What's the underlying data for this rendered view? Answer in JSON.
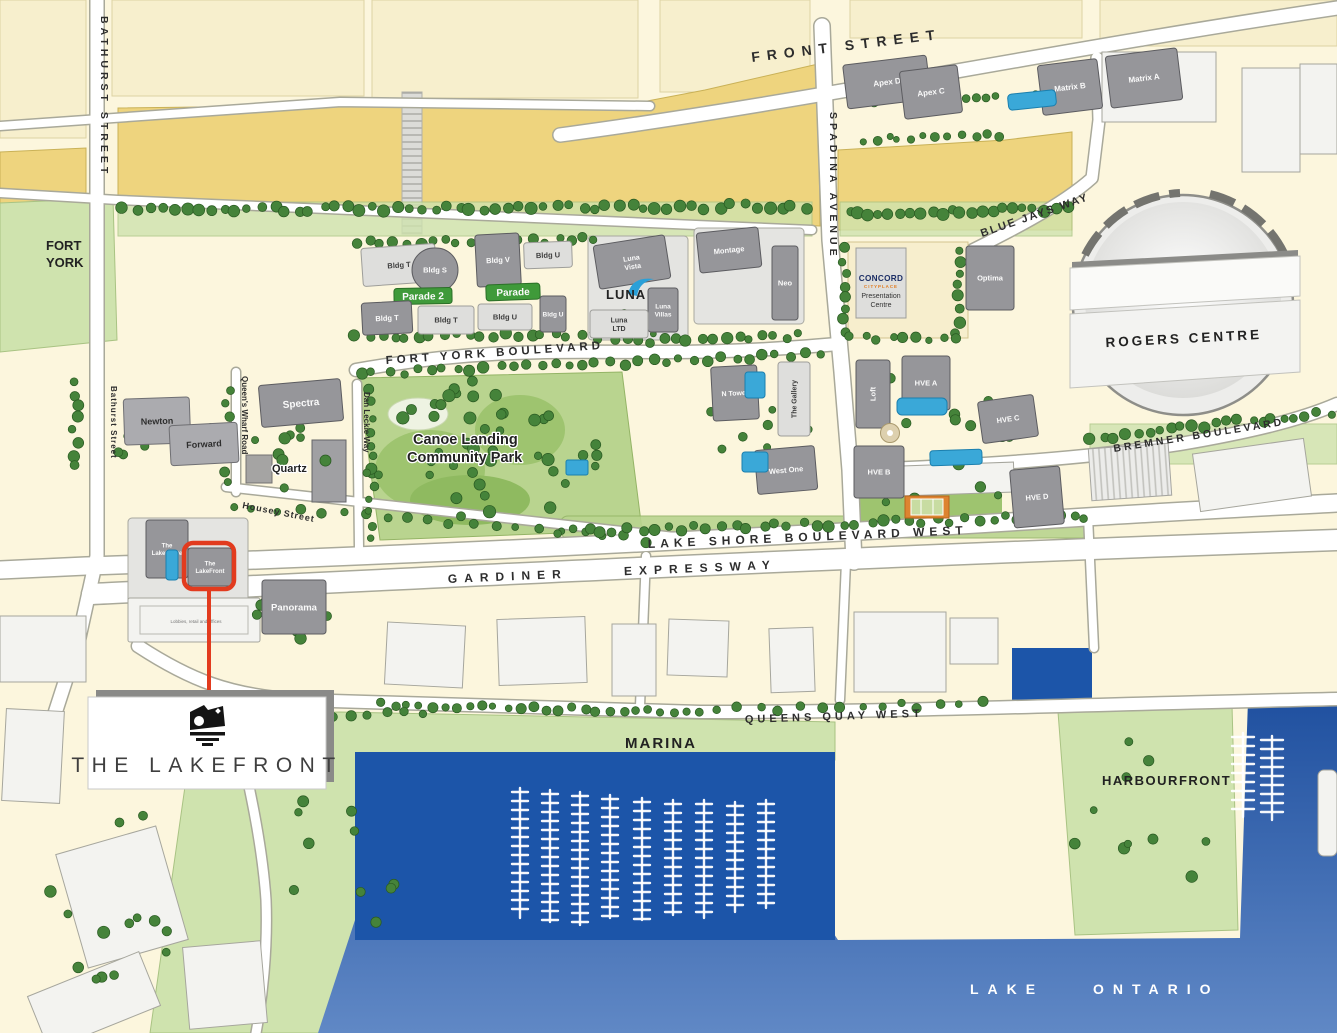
{
  "map": {
    "brand": {
      "name": "THE LAKEFRONT"
    },
    "streets": {
      "front": "FRONT STREET",
      "bathurst_n": "BATHURST STREET",
      "bathurst_s": "Bathurst Street",
      "spadina": "SPADINA AVENUE",
      "blue_jays": "BLUE JAYS WAY",
      "fort_york_blvd": "FORT YORK BOULEVARD",
      "queens_wharf": "Queen's Wharf Road",
      "dan_leckie": "Dan Leckie Way",
      "housey": "Housey Street",
      "lake_shore": "LAKE SHORE BOULEVARD WEST",
      "gardiner": "GARDINER EXPRESSWAY",
      "bremner": "BREMNER BOULEVARD",
      "queens_quay": "QUEENS QUAY WEST"
    },
    "areas": {
      "fort_line1": "FORT",
      "fort_line2": "YORK",
      "canoe_line1": "Canoe Landing",
      "canoe_line2": "Community Park",
      "quartz": "Quartz",
      "marina": "MARINA",
      "harbourfront": "HARBOURFRONT",
      "rogers": "ROGERS CENTRE",
      "lake_ontario": "LAKE ONTARIO",
      "lobbies_note": "Lobbies, retail and offices"
    },
    "concord": {
      "brand": "CONCORD",
      "sub": "CITYPLACE",
      "line1": "Presentation",
      "line2": "Centre"
    },
    "luna_logo": "LUNA",
    "colors": {
      "callout_red": "#e23b1e",
      "court_orange": "#dd8430",
      "water_deep": "#1c55a9",
      "rail_yellow": "#eed47e",
      "park_green": "#b9d48f"
    },
    "buildings": [
      {
        "id": "apex-d",
        "label": "Apex D",
        "x": 845,
        "y": 60,
        "w": 84,
        "h": 44,
        "rot": -7,
        "kind": "dark",
        "fs": 8
      },
      {
        "id": "apex-c",
        "label": "Apex C",
        "x": 902,
        "y": 68,
        "w": 58,
        "h": 48,
        "rot": -7,
        "kind": "dark",
        "fs": 8
      },
      {
        "id": "matrix-b",
        "label": "Matrix B",
        "x": 1040,
        "y": 62,
        "w": 60,
        "h": 50,
        "rot": -7,
        "kind": "dark",
        "fs": 8
      },
      {
        "id": "matrix-a",
        "label": "Matrix A",
        "x": 1108,
        "y": 52,
        "w": 72,
        "h": 52,
        "rot": -7,
        "kind": "dark",
        "fs": 8
      },
      {
        "id": "bldg-t-1",
        "label": "Bldg T",
        "x": 362,
        "y": 246,
        "w": 74,
        "h": 38,
        "rot": -4,
        "kind": "light",
        "fs": 7.5
      },
      {
        "id": "bldg-s",
        "label": "Bldg S",
        "x": 412,
        "y": 248,
        "w": 46,
        "h": 44,
        "rot": 0,
        "kind": "dark",
        "fs": 7.5,
        "rx": 22
      },
      {
        "id": "parade-2-sign",
        "label": "Parade 2",
        "x": 394,
        "y": 288,
        "w": 58,
        "h": 16,
        "rot": -1,
        "kind": "sign",
        "fs": 10
      },
      {
        "id": "bldg-t-2",
        "label": "Bldg T",
        "x": 362,
        "y": 302,
        "w": 50,
        "h": 32,
        "rot": -3,
        "kind": "dark",
        "fs": 7.5
      },
      {
        "id": "bldg-t-3",
        "label": "Bldg T",
        "x": 418,
        "y": 306,
        "w": 56,
        "h": 28,
        "rot": 0,
        "kind": "light",
        "fs": 7.5
      },
      {
        "id": "bldg-v",
        "label": "Bldg V",
        "x": 476,
        "y": 234,
        "w": 44,
        "h": 52,
        "rot": -3,
        "kind": "dark",
        "fs": 7.5
      },
      {
        "id": "bldg-u-1",
        "label": "Bldg U",
        "x": 524,
        "y": 242,
        "w": 48,
        "h": 26,
        "rot": -2,
        "kind": "light",
        "fs": 7.5
      },
      {
        "id": "parade-sign",
        "label": "Parade",
        "x": 486,
        "y": 284,
        "w": 54,
        "h": 16,
        "rot": -2,
        "kind": "sign",
        "fs": 10
      },
      {
        "id": "bldg-u-2",
        "label": "Bldg U",
        "x": 478,
        "y": 304,
        "w": 54,
        "h": 26,
        "rot": 0,
        "kind": "light",
        "fs": 7.5
      },
      {
        "id": "bldg-u-3",
        "label": "Bldg U",
        "x": 540,
        "y": 296,
        "w": 26,
        "h": 36,
        "rot": 0,
        "kind": "dark",
        "fs": 6.5
      },
      {
        "id": "luna-vista",
        "label": "Luna",
        "label2": "Vista",
        "x": 596,
        "y": 240,
        "w": 72,
        "h": 44,
        "rot": -9,
        "kind": "dark",
        "fs": 7
      },
      {
        "id": "luna-villas",
        "label": "Luna",
        "label2": "Villas",
        "x": 648,
        "y": 288,
        "w": 30,
        "h": 44,
        "rot": 0,
        "kind": "dark",
        "fs": 6.5
      },
      {
        "id": "luna-ltd",
        "label": "Luna",
        "label2": "LTD",
        "x": 590,
        "y": 310,
        "w": 58,
        "h": 28,
        "rot": 0,
        "kind": "light",
        "fs": 7
      },
      {
        "id": "montage",
        "label": "Montage",
        "x": 698,
        "y": 230,
        "w": 62,
        "h": 40,
        "rot": -6,
        "kind": "dark",
        "fs": 7.5
      },
      {
        "id": "neo",
        "label": "Neo",
        "x": 772,
        "y": 246,
        "w": 26,
        "h": 74,
        "rot": 0,
        "kind": "dark",
        "fs": 7.5
      },
      {
        "id": "optima",
        "label": "Optima",
        "x": 966,
        "y": 246,
        "w": 48,
        "h": 64,
        "rot": 0,
        "kind": "dark",
        "fs": 7.5
      },
      {
        "id": "newton",
        "label": "Newton",
        "x": 124,
        "y": 398,
        "w": 66,
        "h": 46,
        "rot": -2,
        "kind": "mid",
        "fs": 9
      },
      {
        "id": "forward",
        "label": "Forward",
        "x": 170,
        "y": 424,
        "w": 68,
        "h": 40,
        "rot": -3,
        "kind": "mid",
        "fs": 9
      },
      {
        "id": "spectra",
        "label": "Spectra",
        "x": 260,
        "y": 382,
        "w": 82,
        "h": 42,
        "rot": -5,
        "kind": "dark",
        "fs": 10
      },
      {
        "id": "n-tower",
        "label": "N Tower",
        "x": 712,
        "y": 366,
        "w": 46,
        "h": 54,
        "rot": -3,
        "kind": "dark",
        "fs": 7
      },
      {
        "id": "the-gallery",
        "label": "The Gallery",
        "x": 778,
        "y": 362,
        "w": 32,
        "h": 74,
        "rot": 0,
        "kind": "light",
        "fs": 7,
        "vert": true
      },
      {
        "id": "west-one",
        "label": "West One",
        "x": 756,
        "y": 448,
        "w": 60,
        "h": 44,
        "rot": -5,
        "kind": "dark",
        "fs": 7.5
      },
      {
        "id": "loft",
        "label": "Loft",
        "x": 856,
        "y": 360,
        "w": 34,
        "h": 68,
        "rot": 0,
        "kind": "dark",
        "fs": 7.5,
        "vert": true
      },
      {
        "id": "hve-a",
        "label": "HVE A",
        "x": 902,
        "y": 356,
        "w": 48,
        "h": 54,
        "rot": 0,
        "kind": "dark",
        "fs": 7.5
      },
      {
        "id": "hve-c",
        "label": "HVE C",
        "x": 980,
        "y": 398,
        "w": 56,
        "h": 42,
        "rot": -8,
        "kind": "dark",
        "fs": 7.5
      },
      {
        "id": "hve-b",
        "label": "HVE B",
        "x": 854,
        "y": 446,
        "w": 50,
        "h": 52,
        "rot": 0,
        "kind": "dark",
        "fs": 7.5
      },
      {
        "id": "hve-d",
        "label": "HVE D",
        "x": 1012,
        "y": 468,
        "w": 50,
        "h": 58,
        "rot": -5,
        "kind": "dark",
        "fs": 7.5
      },
      {
        "id": "the-lakeshore",
        "label": "The",
        "label2": "LakeShore",
        "x": 146,
        "y": 520,
        "w": 42,
        "h": 58,
        "rot": 0,
        "kind": "dark",
        "fs": 6
      },
      {
        "id": "the-lakefront-bldg",
        "label": "The",
        "label2": "LakeFront",
        "x": 188,
        "y": 548,
        "w": 44,
        "h": 38,
        "rot": 0,
        "kind": "dark",
        "fs": 6
      },
      {
        "id": "panorama",
        "label": "Panorama",
        "x": 262,
        "y": 580,
        "w": 64,
        "h": 54,
        "rot": 0,
        "kind": "dark",
        "fs": 9.5
      }
    ]
  }
}
